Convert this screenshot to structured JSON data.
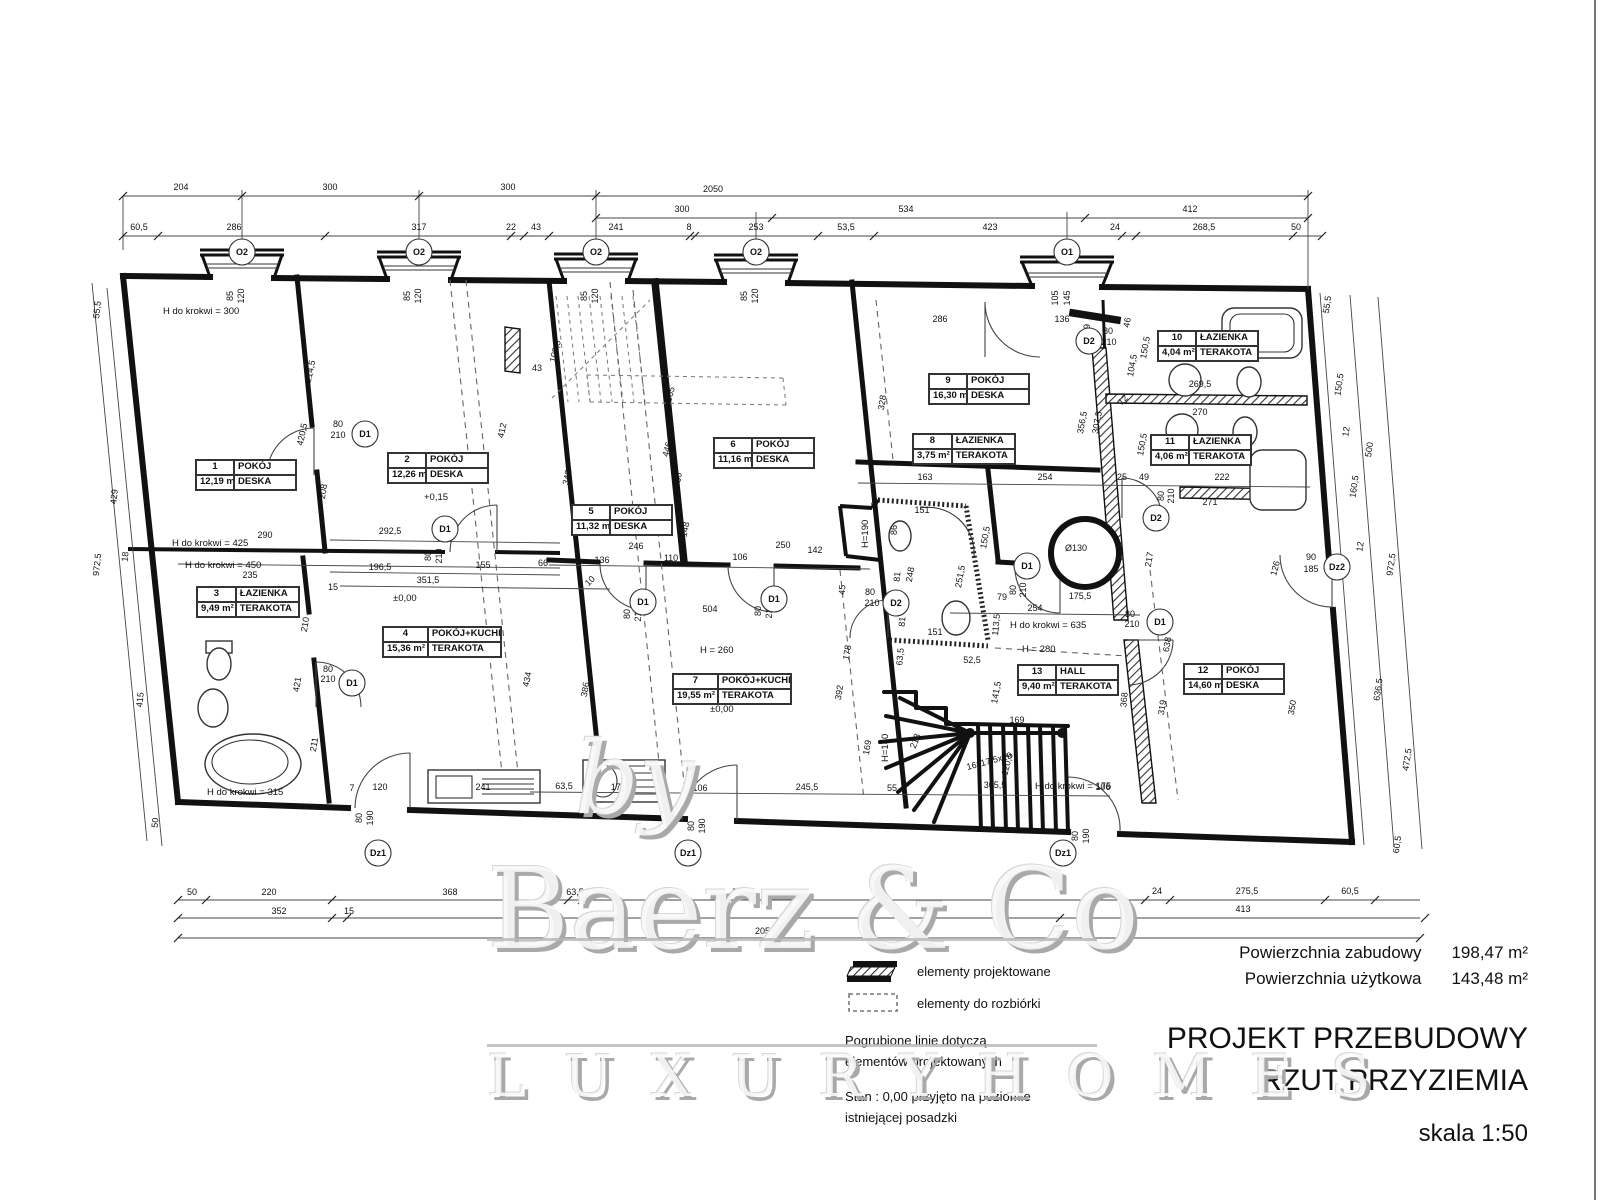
{
  "title_block": {
    "area_built_label": "Powierzchnia zabudowy",
    "area_built_value": "198,47 m²",
    "area_usable_label": "Powierzchnia użytkowa",
    "area_usable_value": "143,48 m²",
    "title_line1": "PROJEKT PRZEBUDOWY",
    "title_line2": "RZUT PRZYZIEMIA",
    "scale": "skala 1:50"
  },
  "legend": {
    "item_projected": "elementy projektowane",
    "item_demolition": "elementy do rozbiórki",
    "note1_line1": "Pogrubione linie dotyczą",
    "note1_line2": "elementów projektowanych",
    "note2_line1": "Stan : 0,00 przyjęto na poziomie",
    "note2_line2": "istniejącej posadzki"
  },
  "watermark": {
    "by": "by",
    "name": "Baerz & Co",
    "tagline": "L U X U R Y   H O M E S"
  },
  "rooms": [
    {
      "number": "1",
      "name": "POKÓJ",
      "area": "12,19 m²",
      "floor": "DESKA",
      "x": 195,
      "y": 459,
      "w": 100
    },
    {
      "number": "2",
      "name": "POKÓJ",
      "area": "12,26 m²",
      "floor": "DESKA",
      "x": 387,
      "y": 452,
      "w": 100
    },
    {
      "number": "3",
      "name": "ŁAZIENKA",
      "area": "9,49 m²",
      "floor": "TERAKOTA",
      "x": 196,
      "y": 586,
      "w": 102
    },
    {
      "number": "4",
      "name": "POKÓJ+KUCHNIA",
      "area": "15,36 m²",
      "floor": "TERAKOTA",
      "x": 382,
      "y": 626,
      "w": 118
    },
    {
      "number": "5",
      "name": "POKÓJ",
      "area": "11,32 m²",
      "floor": "DESKA",
      "x": 571,
      "y": 504,
      "w": 100
    },
    {
      "number": "6",
      "name": "POKÓJ",
      "area": "11,16 m²",
      "floor": "DESKA",
      "x": 713,
      "y": 437,
      "w": 100
    },
    {
      "number": "7",
      "name": "POKÓJ+KUCHNIA",
      "area": "19,55 m²",
      "floor": "TERAKOTA",
      "x": 672,
      "y": 673,
      "w": 118
    },
    {
      "number": "8",
      "name": "ŁAZIENKA",
      "area": "3,75 m²",
      "floor": "TERAKOTA",
      "x": 912,
      "y": 433,
      "w": 102
    },
    {
      "number": "9",
      "name": "POKÓJ",
      "area": "16,30 m²",
      "floor": "DESKA",
      "x": 928,
      "y": 373,
      "w": 100
    },
    {
      "number": "10",
      "name": "ŁAZIENKA",
      "area": "4,04 m²",
      "floor": "TERAKOTA",
      "x": 1157,
      "y": 330,
      "w": 100
    },
    {
      "number": "11",
      "name": "ŁAZIENKA",
      "area": "4,06 m²",
      "floor": "TERAKOTA",
      "x": 1150,
      "y": 434,
      "w": 100
    },
    {
      "number": "12",
      "name": "POKÓJ",
      "area": "14,60 m²",
      "floor": "DESKA",
      "x": 1183,
      "y": 663,
      "w": 100
    },
    {
      "number": "13",
      "name": "HALL",
      "area": "9,40 m²",
      "floor": "TERAKOTA",
      "x": 1017,
      "y": 664,
      "w": 100
    }
  ],
  "markers": [
    {
      "label": "O2",
      "x": 242,
      "y": 252
    },
    {
      "label": "O2",
      "x": 419,
      "y": 252
    },
    {
      "label": "O2",
      "x": 596,
      "y": 252
    },
    {
      "label": "O2",
      "x": 756,
      "y": 252
    },
    {
      "label": "O1",
      "x": 1067,
      "y": 252
    },
    {
      "label": "D1",
      "x": 365,
      "y": 434
    },
    {
      "label": "D1",
      "x": 445,
      "y": 529
    },
    {
      "label": "D1",
      "x": 352,
      "y": 683
    },
    {
      "label": "D1",
      "x": 643,
      "y": 602
    },
    {
      "label": "D1",
      "x": 774,
      "y": 599
    },
    {
      "label": "D1",
      "x": 1027,
      "y": 566
    },
    {
      "label": "D1",
      "x": 1160,
      "y": 622
    },
    {
      "label": "D2",
      "x": 1089,
      "y": 341
    },
    {
      "label": "D2",
      "x": 896,
      "y": 603
    },
    {
      "label": "D2",
      "x": 1156,
      "y": 518
    },
    {
      "label": "Dz1",
      "x": 378,
      "y": 853
    },
    {
      "label": "Dz1",
      "x": 688,
      "y": 853
    },
    {
      "label": "Dz1",
      "x": 1063,
      "y": 853
    },
    {
      "label": "Dz2",
      "x": 1337,
      "y": 567
    }
  ],
  "annotations": [
    {
      "t": "H do krokwi = 300",
      "x": 163,
      "y": 314
    },
    {
      "t": "H do krokwi = 425",
      "x": 172,
      "y": 546
    },
    {
      "t": "H do krokwi = 450",
      "x": 185,
      "y": 568
    },
    {
      "t": "H do krokwi = 315",
      "x": 207,
      "y": 795
    },
    {
      "t": "H do krokwi = 635",
      "x": 1010,
      "y": 628
    },
    {
      "t": "H do krokwi = 175",
      "x": 1035,
      "y": 789
    },
    {
      "t": "H = 280",
      "x": 1022,
      "y": 652
    },
    {
      "t": "H = 260",
      "x": 700,
      "y": 653
    },
    {
      "t": "±0,00",
      "x": 393,
      "y": 601
    },
    {
      "t": "±0,00",
      "x": 710,
      "y": 712
    },
    {
      "t": "+0,15",
      "x": 424,
      "y": 500
    },
    {
      "t": "H=190",
      "x": 868,
      "y": 548,
      "r": -90
    },
    {
      "t": "H=140",
      "x": 888,
      "y": 762,
      "r": -90
    }
  ],
  "dim_texts": [
    {
      "t": "204",
      "x": 181,
      "y": 190
    },
    {
      "t": "300",
      "x": 330,
      "y": 190
    },
    {
      "t": "300",
      "x": 508,
      "y": 190
    },
    {
      "t": "2050",
      "x": 713,
      "y": 192
    },
    {
      "t": "300",
      "x": 682,
      "y": 212
    },
    {
      "t": "534",
      "x": 906,
      "y": 212
    },
    {
      "t": "412",
      "x": 1190,
      "y": 212
    },
    {
      "t": "60,5",
      "x": 139,
      "y": 230
    },
    {
      "t": "286",
      "x": 234,
      "y": 230
    },
    {
      "t": "317",
      "x": 419,
      "y": 230
    },
    {
      "t": "22",
      "x": 511,
      "y": 230
    },
    {
      "t": "43",
      "x": 536,
      "y": 230
    },
    {
      "t": "241",
      "x": 616,
      "y": 230
    },
    {
      "t": "8",
      "x": 689,
      "y": 230
    },
    {
      "t": "253",
      "x": 756,
      "y": 230
    },
    {
      "t": "53,5",
      "x": 846,
      "y": 230
    },
    {
      "t": "423",
      "x": 990,
      "y": 230
    },
    {
      "t": "24",
      "x": 1115,
      "y": 230
    },
    {
      "t": "268,5",
      "x": 1204,
      "y": 230
    },
    {
      "t": "50",
      "x": 1296,
      "y": 230
    },
    {
      "t": "50",
      "x": 192,
      "y": 895
    },
    {
      "t": "220",
      "x": 269,
      "y": 895
    },
    {
      "t": "368",
      "x": 450,
      "y": 895
    },
    {
      "t": "63,5",
      "x": 575,
      "y": 895
    },
    {
      "t": "507",
      "x": 740,
      "y": 895
    },
    {
      "t": "24",
      "x": 1157,
      "y": 894
    },
    {
      "t": "275,5",
      "x": 1247,
      "y": 894
    },
    {
      "t": "60,5",
      "x": 1350,
      "y": 894
    },
    {
      "t": "352",
      "x": 279,
      "y": 914
    },
    {
      "t": "15",
      "x": 349,
      "y": 914
    },
    {
      "t": "413",
      "x": 1243,
      "y": 912
    },
    {
      "t": "2050",
      "x": 765,
      "y": 934
    },
    {
      "t": "55,5",
      "x": 100,
      "y": 310,
      "r": -84
    },
    {
      "t": "429",
      "x": 117,
      "y": 497,
      "r": -84
    },
    {
      "t": "18",
      "x": 128,
      "y": 557,
      "r": -84
    },
    {
      "t": "972,5",
      "x": 100,
      "y": 565,
      "r": -84
    },
    {
      "t": "415",
      "x": 143,
      "y": 700,
      "r": -84
    },
    {
      "t": "50",
      "x": 158,
      "y": 823,
      "r": -84
    },
    {
      "t": "55,5",
      "x": 1330,
      "y": 305,
      "r": -82
    },
    {
      "t": "150,5",
      "x": 1342,
      "y": 385,
      "r": -82
    },
    {
      "t": "12",
      "x": 1349,
      "y": 432,
      "r": -82
    },
    {
      "t": "500",
      "x": 1372,
      "y": 450,
      "r": -82
    },
    {
      "t": "160,5",
      "x": 1357,
      "y": 487,
      "r": -82
    },
    {
      "t": "12",
      "x": 1363,
      "y": 547,
      "r": -82
    },
    {
      "t": "972,5",
      "x": 1394,
      "y": 565,
      "r": -82
    },
    {
      "t": "636,5",
      "x": 1381,
      "y": 690,
      "r": -82
    },
    {
      "t": "472,5",
      "x": 1410,
      "y": 760,
      "r": -82
    },
    {
      "t": "60,5",
      "x": 1400,
      "y": 845,
      "r": -82
    },
    {
      "t": "85",
      "x": 233,
      "y": 296,
      "r": -90
    },
    {
      "t": "120",
      "x": 244,
      "y": 296,
      "r": -90
    },
    {
      "t": "85",
      "x": 410,
      "y": 296,
      "r": -90
    },
    {
      "t": "120",
      "x": 421,
      "y": 296,
      "r": -90
    },
    {
      "t": "85",
      "x": 587,
      "y": 296,
      "r": -90
    },
    {
      "t": "120",
      "x": 598,
      "y": 296,
      "r": -90
    },
    {
      "t": "85",
      "x": 747,
      "y": 296,
      "r": -90
    },
    {
      "t": "120",
      "x": 758,
      "y": 296,
      "r": -90
    },
    {
      "t": "105",
      "x": 1058,
      "y": 298,
      "r": -90
    },
    {
      "t": "145",
      "x": 1070,
      "y": 298,
      "r": -90
    },
    {
      "t": "214,5",
      "x": 313,
      "y": 372,
      "r": -78
    },
    {
      "t": "420,5",
      "x": 305,
      "y": 435,
      "r": -78
    },
    {
      "t": "80",
      "x": 338,
      "y": 427
    },
    {
      "t": "210",
      "x": 338,
      "y": 438
    },
    {
      "t": "208",
      "x": 326,
      "y": 492,
      "r": -80
    },
    {
      "t": "290",
      "x": 265,
      "y": 538
    },
    {
      "t": "292,5",
      "x": 390,
      "y": 534
    },
    {
      "t": "196,5",
      "x": 380,
      "y": 570
    },
    {
      "t": "351,5",
      "x": 428,
      "y": 583
    },
    {
      "t": "155",
      "x": 483,
      "y": 568
    },
    {
      "t": "66",
      "x": 543,
      "y": 566
    },
    {
      "t": "235",
      "x": 250,
      "y": 578
    },
    {
      "t": "412",
      "x": 505,
      "y": 431,
      "r": -78
    },
    {
      "t": "43",
      "x": 537,
      "y": 371
    },
    {
      "t": "80",
      "x": 431,
      "y": 556,
      "r": -90
    },
    {
      "t": "210",
      "x": 442,
      "y": 556,
      "r": -90
    },
    {
      "t": "210",
      "x": 308,
      "y": 625,
      "r": -80
    },
    {
      "t": "421",
      "x": 300,
      "y": 685,
      "r": -80
    },
    {
      "t": "211",
      "x": 317,
      "y": 745,
      "r": -80
    },
    {
      "t": "15",
      "x": 333,
      "y": 590
    },
    {
      "t": "434",
      "x": 530,
      "y": 680,
      "r": -78
    },
    {
      "t": "241",
      "x": 483,
      "y": 790
    },
    {
      "t": "7",
      "x": 352,
      "y": 791
    },
    {
      "t": "120",
      "x": 380,
      "y": 790
    },
    {
      "t": "80",
      "x": 328,
      "y": 672
    },
    {
      "t": "210",
      "x": 328,
      "y": 682
    },
    {
      "t": "80",
      "x": 362,
      "y": 818,
      "r": -90
    },
    {
      "t": "190",
      "x": 373,
      "y": 818,
      "r": -90
    },
    {
      "t": "108,5",
      "x": 558,
      "y": 352,
      "r": -75
    },
    {
      "t": "342",
      "x": 570,
      "y": 478,
      "r": -78
    },
    {
      "t": "265",
      "x": 673,
      "y": 395,
      "r": -75
    },
    {
      "t": "446",
      "x": 670,
      "y": 450,
      "r": -76
    },
    {
      "t": "36",
      "x": 681,
      "y": 478,
      "r": -80
    },
    {
      "t": "148",
      "x": 688,
      "y": 530,
      "r": -78
    },
    {
      "t": "136",
      "x": 602,
      "y": 563
    },
    {
      "t": "110",
      "x": 671,
      "y": 561
    },
    {
      "t": "106",
      "x": 740,
      "y": 560
    },
    {
      "t": "250",
      "x": 783,
      "y": 548
    },
    {
      "t": "142",
      "x": 815,
      "y": 553
    },
    {
      "t": "246",
      "x": 636,
      "y": 549
    },
    {
      "t": "10",
      "x": 592,
      "y": 583,
      "r": -45
    },
    {
      "t": "80",
      "x": 630,
      "y": 614,
      "r": -90
    },
    {
      "t": "210",
      "x": 641,
      "y": 614,
      "r": -90
    },
    {
      "t": "80",
      "x": 761,
      "y": 611,
      "r": -90
    },
    {
      "t": "210",
      "x": 772,
      "y": 611,
      "r": -90
    },
    {
      "t": "504",
      "x": 710,
      "y": 612
    },
    {
      "t": "386",
      "x": 588,
      "y": 690,
      "r": -80
    },
    {
      "t": "63,5",
      "x": 564,
      "y": 789
    },
    {
      "t": "175,5",
      "x": 622,
      "y": 790
    },
    {
      "t": "106",
      "x": 700,
      "y": 791
    },
    {
      "t": "245,5",
      "x": 807,
      "y": 790
    },
    {
      "t": "55",
      "x": 892,
      "y": 791
    },
    {
      "t": "80",
      "x": 694,
      "y": 826,
      "r": -90
    },
    {
      "t": "190",
      "x": 705,
      "y": 826,
      "r": -90
    },
    {
      "t": "178",
      "x": 850,
      "y": 653,
      "r": -80
    },
    {
      "t": "392",
      "x": 842,
      "y": 693,
      "r": -80
    },
    {
      "t": "169",
      "x": 870,
      "y": 748,
      "r": -80
    },
    {
      "t": "45",
      "x": 845,
      "y": 590,
      "r": -85
    },
    {
      "t": "80",
      "x": 870,
      "y": 595
    },
    {
      "t": "210",
      "x": 872,
      "y": 606
    },
    {
      "t": "286",
      "x": 940,
      "y": 322
    },
    {
      "t": "136",
      "x": 1062,
      "y": 322
    },
    {
      "t": "49",
      "x": 1090,
      "y": 329,
      "r": -90
    },
    {
      "t": "80",
      "x": 1108,
      "y": 334
    },
    {
      "t": "210",
      "x": 1109,
      "y": 345
    },
    {
      "t": "46",
      "x": 1130,
      "y": 323,
      "r": -80
    },
    {
      "t": "150,5",
      "x": 1148,
      "y": 348,
      "r": -80
    },
    {
      "t": "104,5",
      "x": 1135,
      "y": 366,
      "r": -80
    },
    {
      "t": "328",
      "x": 885,
      "y": 403,
      "r": -80
    },
    {
      "t": "356,5",
      "x": 1085,
      "y": 423,
      "r": -80
    },
    {
      "t": "307,5",
      "x": 1100,
      "y": 423,
      "r": -80
    },
    {
      "t": "269,5",
      "x": 1200,
      "y": 387
    },
    {
      "t": "270",
      "x": 1200,
      "y": 415
    },
    {
      "t": "150,5",
      "x": 1145,
      "y": 445,
      "r": -80
    },
    {
      "t": "417",
      "x": 995,
      "y": 468
    },
    {
      "t": "163",
      "x": 925,
      "y": 480
    },
    {
      "t": "254",
      "x": 1045,
      "y": 480
    },
    {
      "t": "25",
      "x": 1122,
      "y": 480
    },
    {
      "t": "49",
      "x": 1144,
      "y": 480
    },
    {
      "t": "222",
      "x": 1222,
      "y": 480
    },
    {
      "t": "271",
      "x": 1210,
      "y": 505
    },
    {
      "t": "80",
      "x": 1164,
      "y": 496,
      "r": -90
    },
    {
      "t": "210",
      "x": 1174,
      "y": 496,
      "r": -90
    },
    {
      "t": "217",
      "x": 1152,
      "y": 560,
      "r": -80
    },
    {
      "t": "151",
      "x": 922,
      "y": 513
    },
    {
      "t": "86",
      "x": 897,
      "y": 530,
      "r": -90
    },
    {
      "t": "248",
      "x": 913,
      "y": 575,
      "r": -80
    },
    {
      "t": "81",
      "x": 900,
      "y": 577,
      "r": -85
    },
    {
      "t": "81",
      "x": 905,
      "y": 622,
      "r": -85
    },
    {
      "t": "251,5",
      "x": 963,
      "y": 577,
      "r": -80
    },
    {
      "t": "150,5",
      "x": 988,
      "y": 538,
      "r": -80
    },
    {
      "t": "63,5",
      "x": 903,
      "y": 657,
      "r": -85
    },
    {
      "t": "52,5",
      "x": 972,
      "y": 663
    },
    {
      "t": "151",
      "x": 935,
      "y": 635
    },
    {
      "t": "79",
      "x": 1002,
      "y": 600
    },
    {
      "t": "113,5",
      "x": 999,
      "y": 625,
      "r": -85
    },
    {
      "t": "80",
      "x": 1016,
      "y": 590,
      "r": -90
    },
    {
      "t": "210",
      "x": 1026,
      "y": 590,
      "r": -90
    },
    {
      "t": "141,5",
      "x": 999,
      "y": 693,
      "r": -80
    },
    {
      "t": "213",
      "x": 918,
      "y": 742,
      "r": -70
    },
    {
      "t": "120,5",
      "x": 1010,
      "y": 765,
      "r": -75
    },
    {
      "t": "305,5",
      "x": 995,
      "y": 788
    },
    {
      "t": "169",
      "x": 1017,
      "y": 723
    },
    {
      "t": "16x17,5x29",
      "x": 990,
      "y": 764,
      "r": -15
    },
    {
      "t": "175,5",
      "x": 1080,
      "y": 599
    },
    {
      "t": "254",
      "x": 1035,
      "y": 611
    },
    {
      "t": "80",
      "x": 1130,
      "y": 617
    },
    {
      "t": "210",
      "x": 1132,
      "y": 627
    },
    {
      "t": "638",
      "x": 1170,
      "y": 645,
      "r": -80
    },
    {
      "t": "319",
      "x": 1165,
      "y": 708,
      "r": -80
    },
    {
      "t": "368",
      "x": 1127,
      "y": 700,
      "r": -85
    },
    {
      "t": "350",
      "x": 1295,
      "y": 708,
      "r": -80
    },
    {
      "t": "126",
      "x": 1278,
      "y": 569,
      "r": -75
    },
    {
      "t": "90",
      "x": 1311,
      "y": 560
    },
    {
      "t": "185",
      "x": 1311,
      "y": 572
    },
    {
      "t": "106",
      "x": 1103,
      "y": 790
    },
    {
      "t": "80",
      "x": 1078,
      "y": 836,
      "r": -90
    },
    {
      "t": "190",
      "x": 1089,
      "y": 836,
      "r": -90
    },
    {
      "t": "Ø130",
      "x": 1076,
      "y": 551
    },
    {
      "t": "32",
      "x": 878,
      "y": 502,
      "r": -80
    },
    {
      "t": "12",
      "x": 1125,
      "y": 402,
      "r": -45
    }
  ]
}
